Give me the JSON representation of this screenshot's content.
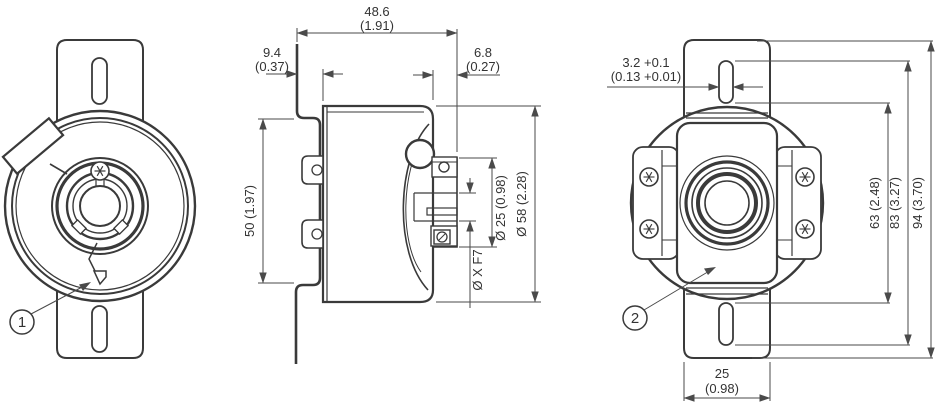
{
  "drawing_title": "Encoder dimensional drawing, three views",
  "colors": {
    "line": "#3a3a3a",
    "dim": "#4a4a4a",
    "text": "#333333",
    "background": "#ffffff"
  },
  "dims": {
    "d486mm": "48.6",
    "d486in": "(1.91)",
    "d94mm": "9.4",
    "d94in": "(0.37)",
    "d68mm": "6.8",
    "d68in": "(0.27)",
    "d50": "50 (1.97)",
    "dia25": "Ø 25 (0.98)",
    "dia58": "Ø 58 (2.28)",
    "diax": "Ø X F7",
    "d32mm": "3.2 +0.1",
    "d32in": "(0.13 +0.01)",
    "d63": "63 (2.48)",
    "d83": "83 (3.27)",
    "d94": "94 (3.70)",
    "d25mm": "25",
    "d25in": "(0.98)"
  },
  "callouts": {
    "c1": "1",
    "c2": "2"
  }
}
